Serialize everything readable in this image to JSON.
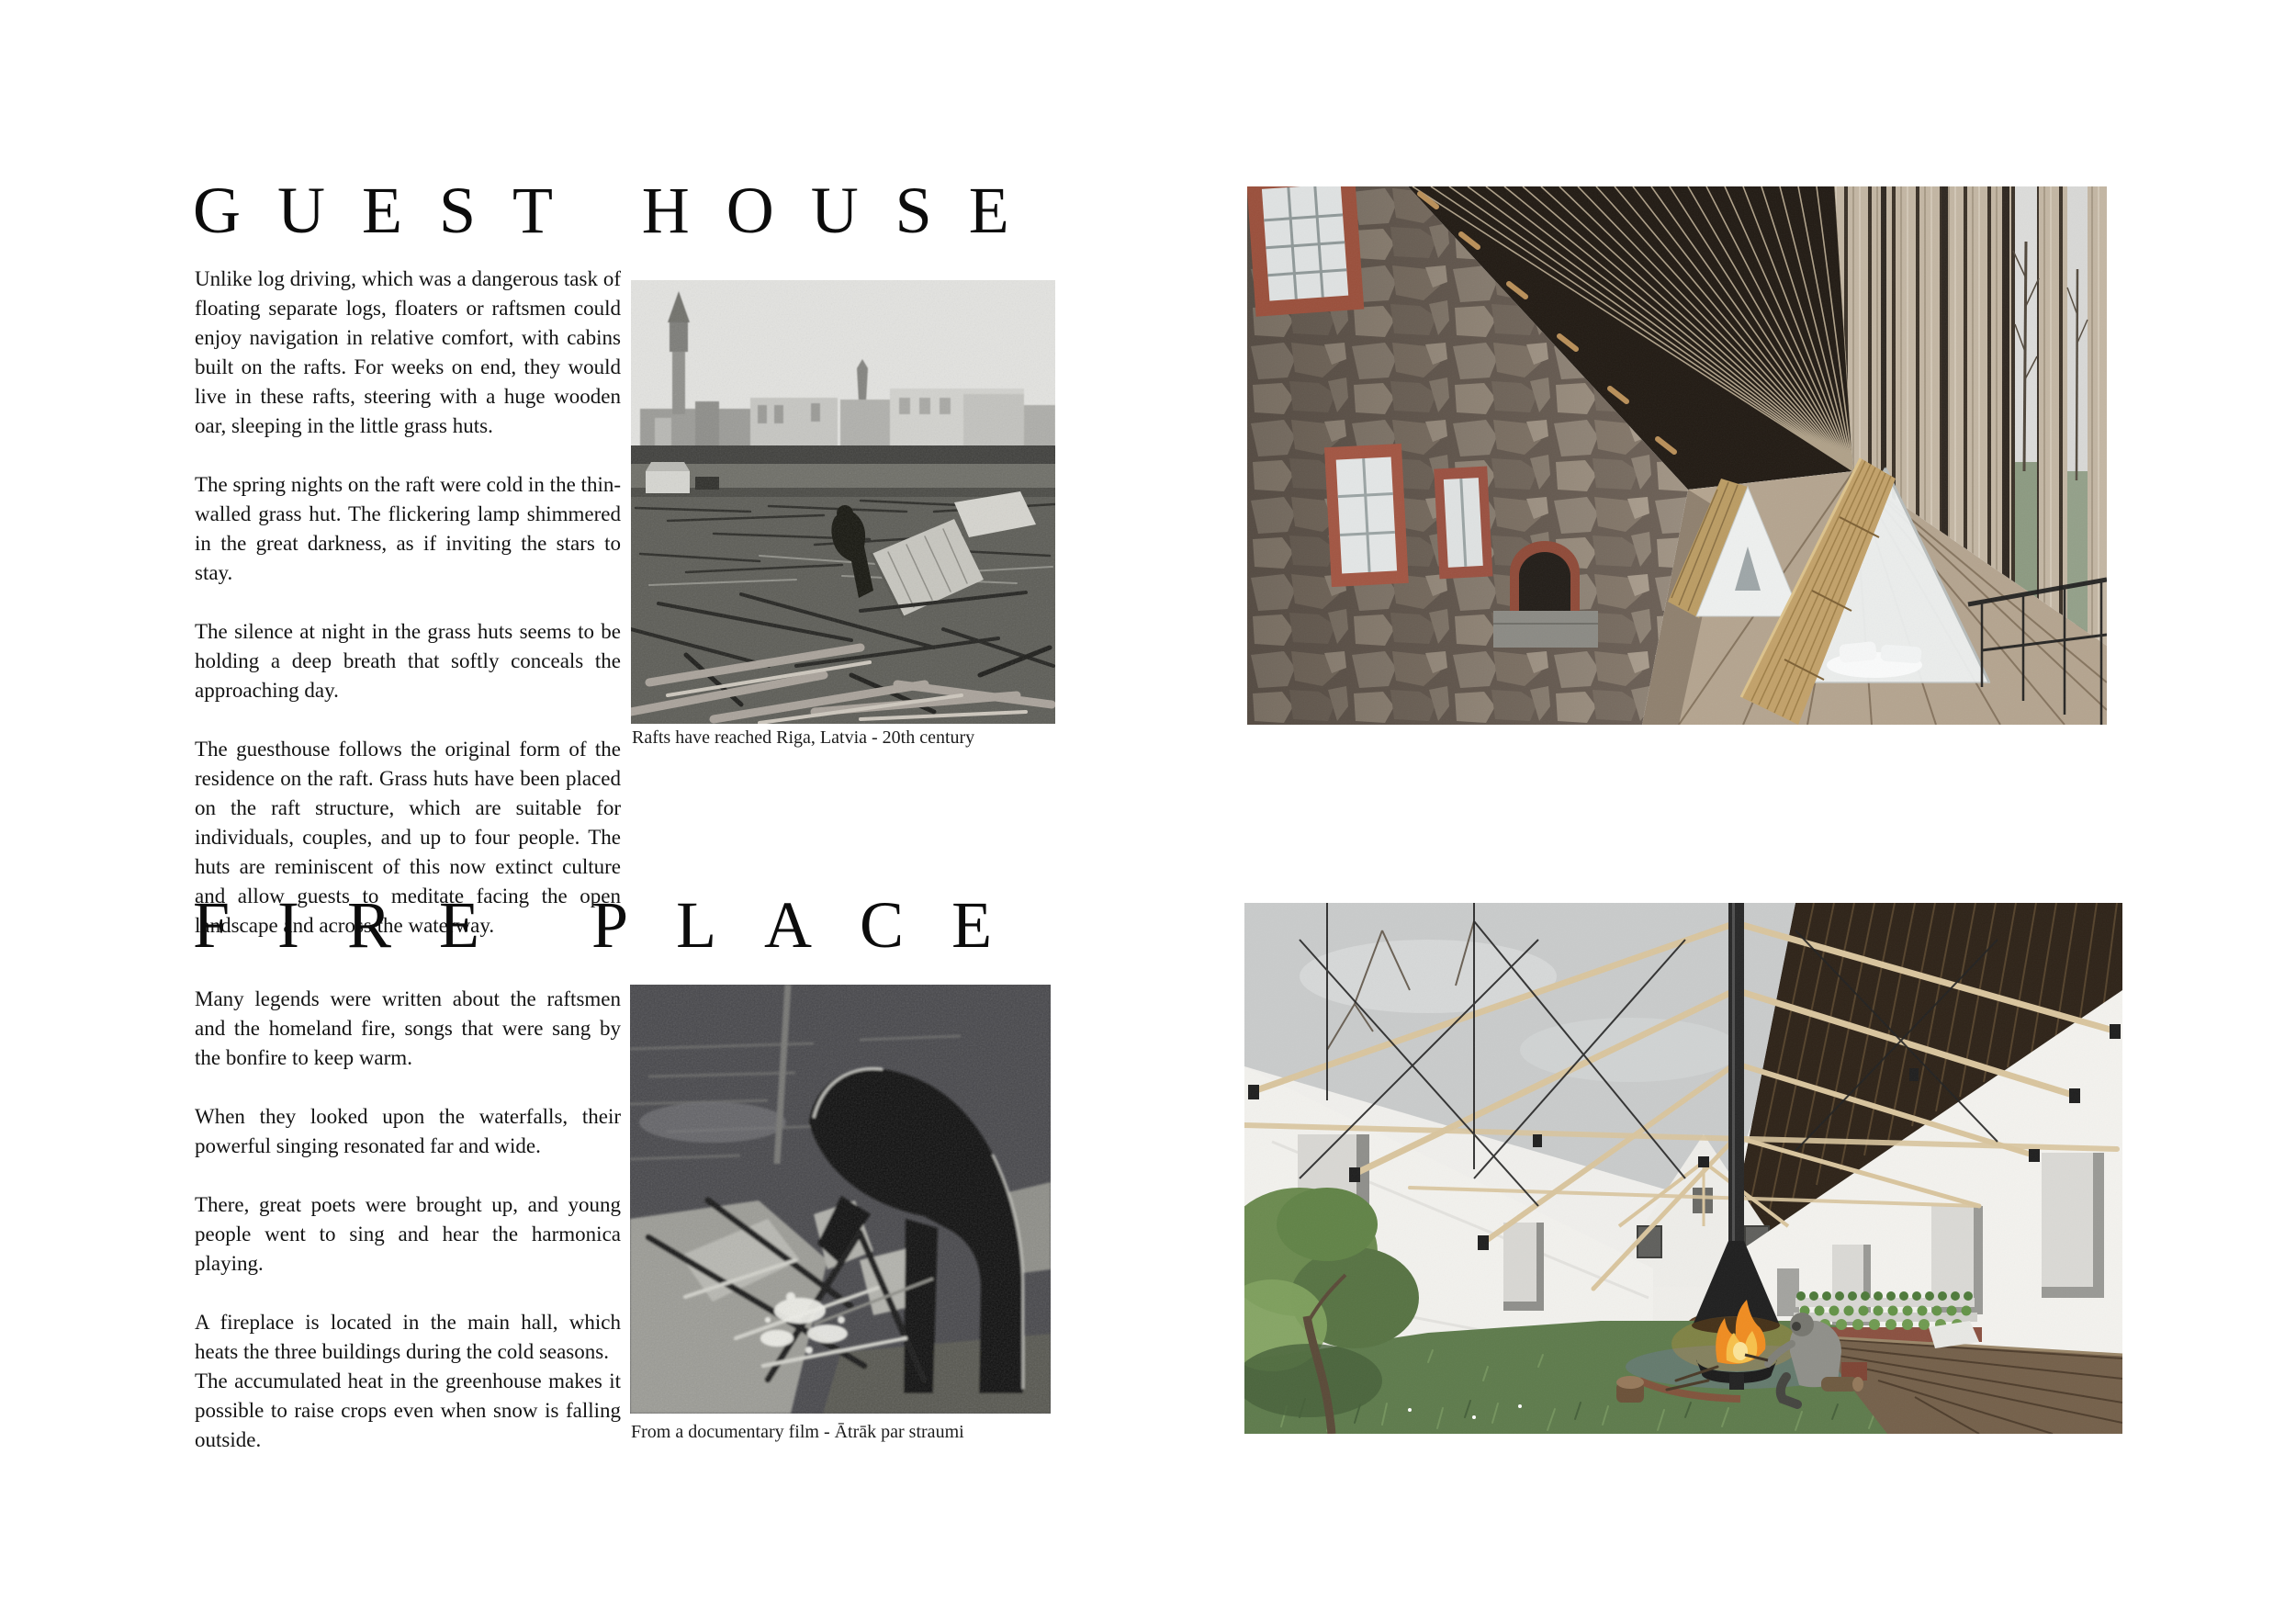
{
  "palette": {
    "paper": "#ffffff",
    "ink": "#111111"
  },
  "guest_house": {
    "title": "GUEST HOUSE",
    "paragraphs": [
      "Unlike log driving, which was a dangerous task of floating separate logs, floaters or raftsmen could enjoy navigation in relative comfort, with cabins built on the rafts. For weeks on end, they would live in these rafts, steering with a huge wooden oar, sleeping in the little grass huts.",
      "The spring nights on the raft were cold in the thin-walled grass hut. The flickering lamp shimmered in the great darkness, as if inviting the stars to stay.",
      "The silence at night in the grass huts seems to be holding a deep breath that softly conceals the approaching day.",
      "The guesthouse follows the original form of the residence on the raft. Grass huts have been placed on the raft structure, which are suitable for individuals, couples, and up to four people. The huts are reminiscent of this now extinct culture and allow guests to meditate facing the open landscape and across the waterway."
    ],
    "photo_caption": "Rafts have reached Riga, Latvia - 20th century"
  },
  "fire_place": {
    "title": "FIRE PLACE",
    "paragraphs": [
      "Many legends were written about the raftsmen and the homeland fire, songs that were sang by the bonfire to keep warm.",
      "When they looked upon the waterfalls, their powerful singing resonated far and wide.",
      "There, great poets were brought up, and young people went to sing and hear the harmonica playing.",
      "A fireplace is located in the main hall, which heats the three buildings during the cold seasons.\nThe accumulated heat in the greenhouse makes it possible to raise crops even when snow is falling outside."
    ],
    "photo_caption": "From a documentary film - Ātrāk par straumi"
  }
}
